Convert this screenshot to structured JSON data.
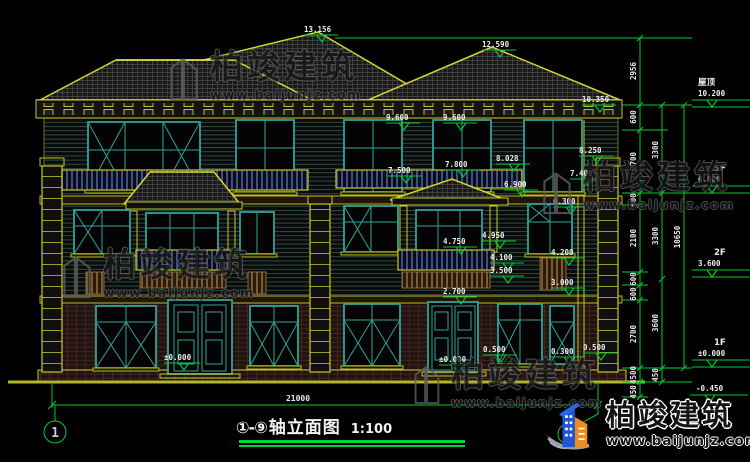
{
  "drawing_title": {
    "range": "①-⑨",
    "text": "轴立面图",
    "scale": "1:100"
  },
  "axis_bubbles": {
    "left": "1",
    "right": "9"
  },
  "bottom_dim": "21000",
  "elev": {
    "ridge_main": "13.156",
    "ridge_right": "12.590",
    "eave_right": "10.350",
    "win3f_a": "9.600",
    "win3f_b": "9.600",
    "rail_8250": "8.250",
    "rail_8028": "8.028",
    "rail_7800": "7.800",
    "rail_7500": "7.500",
    "rail_7400": "7.400",
    "porch_ridge": "6.900",
    "porch_eave": "6.300",
    "post_top": "4.950",
    "balc_rail": "4.750",
    "panel_top": "4.200",
    "balc_floor": "4.100",
    "balc_bot": "3.500",
    "panel_bot": "3.000",
    "door_head": "2.700",
    "plinth_r1": "0.500",
    "plinth_r2": "0.300",
    "plinth_r3": "0.500",
    "grade_left": "±0.000",
    "grade_right": "±0.000"
  },
  "right_dims": {
    "chain_a": [
      "2956",
      "600",
      "2700",
      "600",
      "2100",
      "600",
      "600",
      "2700",
      "4500",
      "450"
    ],
    "chain_b": [
      "3300",
      "3300",
      "3600",
      "450"
    ],
    "chain_c": [
      "10650"
    ],
    "levels": [
      {
        "label": "屋顶",
        "value": "10.200"
      },
      {
        "label": "3F",
        "value": "6.900"
      },
      {
        "label": "2F",
        "value": "3.600"
      },
      {
        "label": "1F",
        "value": "±0.000"
      },
      {
        "label": "",
        "value": "-0.450"
      }
    ]
  },
  "watermark": {
    "brand": "柏竣建筑",
    "url": "www.baijunjz.com"
  },
  "logo": {
    "brand": "柏竣建筑",
    "url": "www.baijunjz.com"
  },
  "colors": {
    "dim_green": "#00cc33",
    "cad_yellow": "#c9c929",
    "frame_cyan": "#2fa39a"
  }
}
